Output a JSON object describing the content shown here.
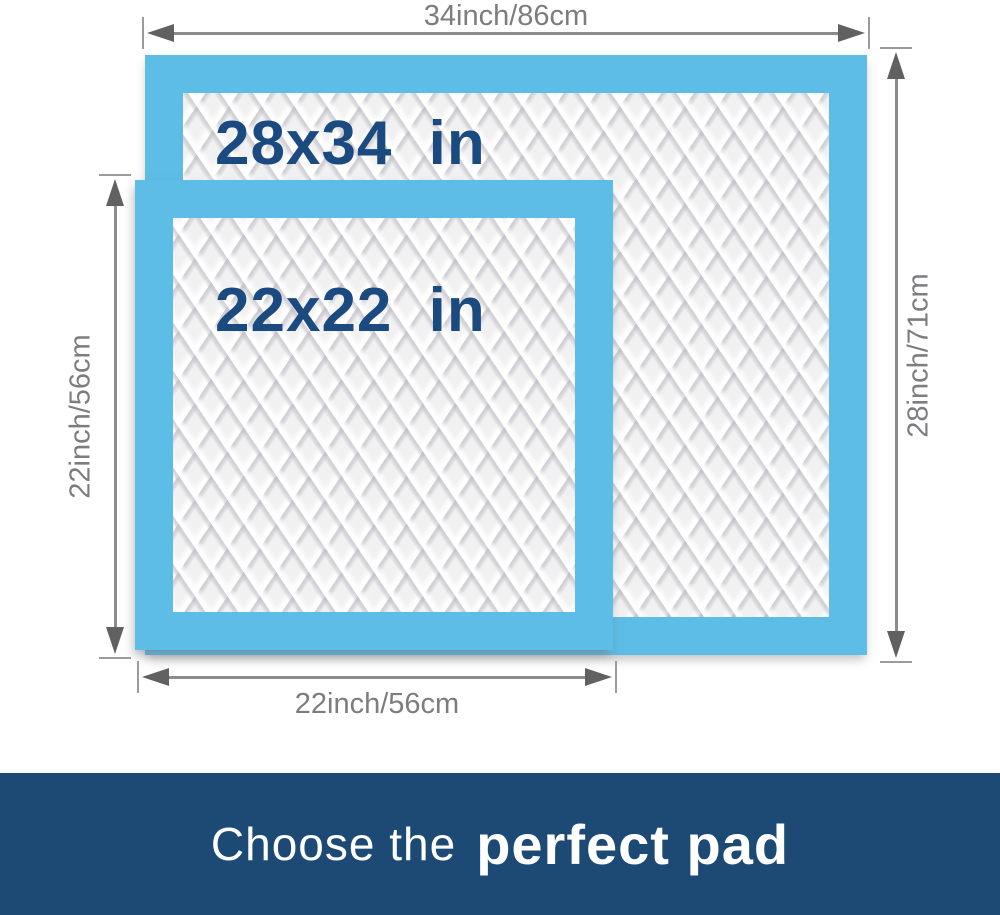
{
  "pads": {
    "large": {
      "label": "28x34 in"
    },
    "small": {
      "label": "22x22 in"
    }
  },
  "dimensions": {
    "top": {
      "label": "34inch/86cm"
    },
    "right": {
      "label": "28inch/71cm"
    },
    "left": {
      "label": "22inch/56cm"
    },
    "bottom": {
      "label": "22inch/56cm"
    }
  },
  "banner": {
    "prefix": "Choose the",
    "emphasis": "perfect pad"
  },
  "colors": {
    "pad_border_blue": "#5EBDE6",
    "pad_quilt_white": "#F1F1F2",
    "size_label_navy": "#1A4A7F",
    "dimension_gray": "#7D7D80",
    "banner_navy": "#1C4A75",
    "banner_text": "#FFFFFF"
  }
}
